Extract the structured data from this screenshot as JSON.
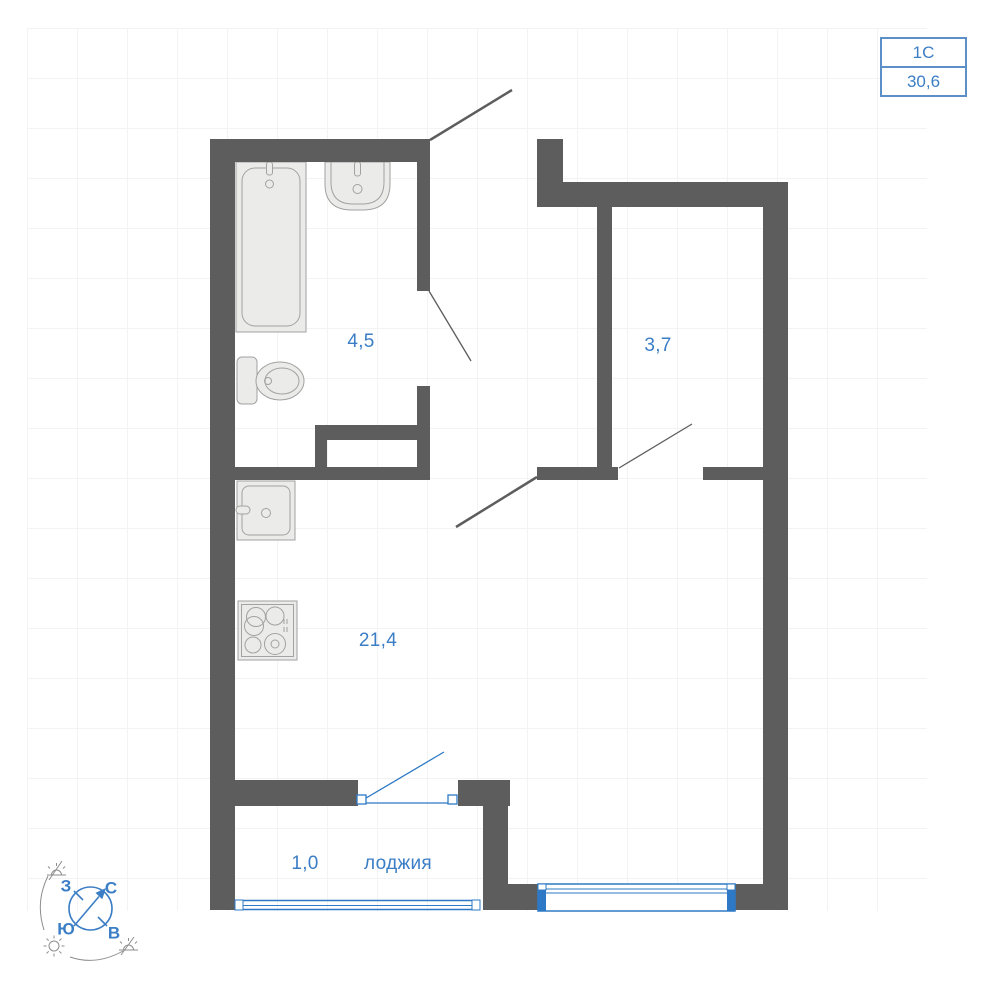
{
  "unit_card": {
    "plan_type": "1С",
    "total_area": "30,6"
  },
  "rooms": {
    "bathroom": {
      "area": "4,5"
    },
    "hall": {
      "area": "3,7"
    },
    "living": {
      "area": "21,4"
    },
    "loggia": {
      "area": "1,0",
      "name": "лоджия"
    }
  },
  "compass": {
    "west": "З",
    "north": "С",
    "south": "Ю",
    "east": "В"
  },
  "colors": {
    "wall": "#5d5d5d",
    "accent_blue": "#3b7ec6",
    "window_blue": "#2e79c5",
    "badge_border": "#5b8fc7",
    "fixture_fill": "#ebebe9",
    "fixture_stroke": "#a2a2a2",
    "grid": "#f3f3f3",
    "decor_gray": "#8d8d8d"
  }
}
